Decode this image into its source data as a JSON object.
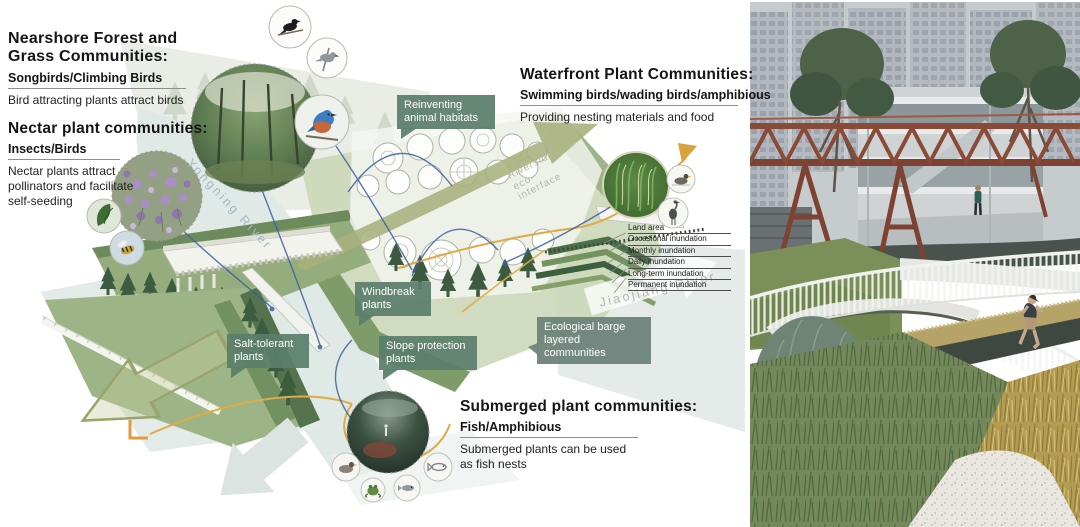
{
  "annotations": {
    "nearshore": {
      "title": "Nearshore Forest and Grass Communities:",
      "subtitle": "Songbirds/Climbing Birds",
      "description": "Bird attracting plants attract birds"
    },
    "nectar": {
      "title": "Nectar plant communities:",
      "subtitle": "Insects/Birds",
      "description": "Nectar plants attract pollinators and facilitate self-seeding"
    },
    "waterfront": {
      "title": "Waterfront Plant Communities:",
      "subtitle": "Swimming birds/wading birds/amphibious",
      "description": "Providing nesting materials and food"
    },
    "submerged": {
      "title": "Submerged plant communities:",
      "subtitle": "Fish/Amphibious",
      "description": "Submerged plants can be used as fish nests"
    }
  },
  "callouts": {
    "reinventing_habitats": "Reinventing animal habitats",
    "windbreak": "Windbreak plants",
    "salt_tolerant": "Salt-tolerant plants",
    "slope_protection": "Slope protection plants",
    "ecological_barge": "Ecological barge layered communities"
  },
  "rivers": {
    "yongning": "Yongning River",
    "jiaojiang": "Jiaojiang River",
    "riverside_interface": "Riverside eco-interface"
  },
  "legend": {
    "items": [
      "Land area",
      "Occasional inundation",
      "Monthly inundation",
      "Daily inundation",
      "Long-term inundation",
      "Permanent inundation"
    ]
  },
  "colors": {
    "callout_green": "#5a7e6c",
    "callout_gray_green": "#6a8077",
    "arrow_olive": "#a8b17c",
    "path_yellow": "#e0aa45",
    "leader_blue": "#3c5fa0",
    "water": "#dfe9e5",
    "bridge_rust": "#8a4a38"
  }
}
